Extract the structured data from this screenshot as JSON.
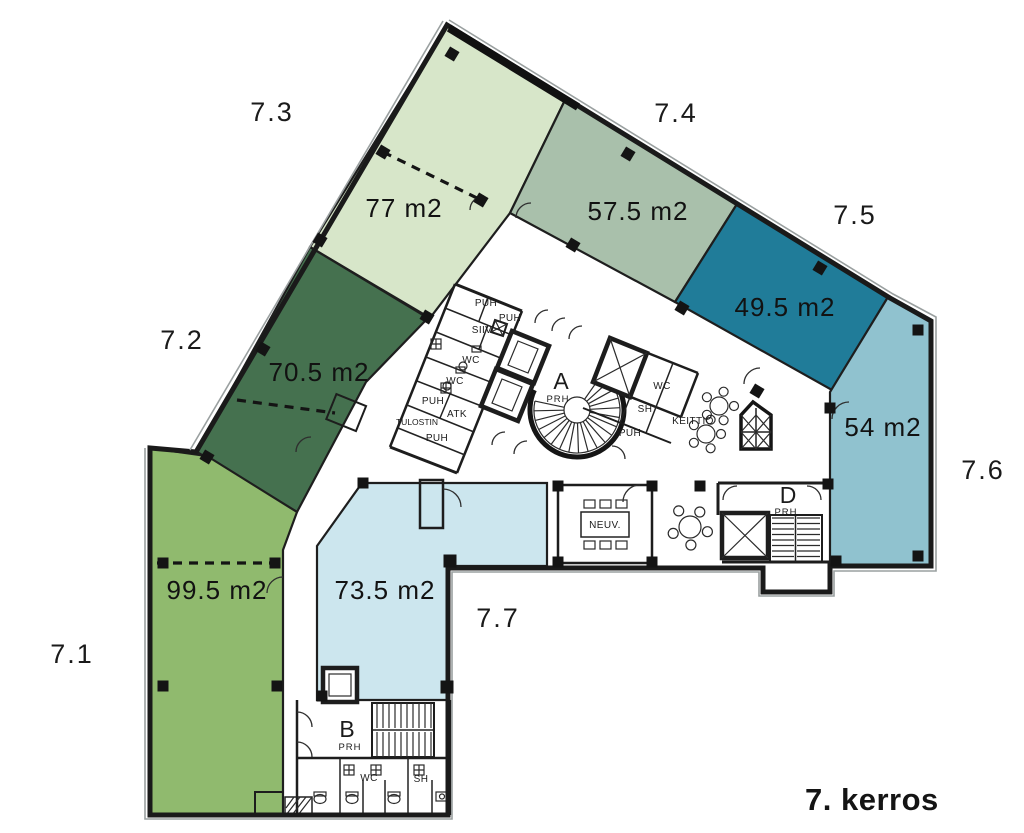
{
  "title": "7. kerros",
  "zones": {
    "z71": {
      "id": "7.1",
      "area": "99.5 m2",
      "color": "#90ba6e"
    },
    "z72": {
      "id": "7.2",
      "area": "70.5 m2",
      "color": "#45714f"
    },
    "z73": {
      "id": "7.3",
      "area": "77 m2",
      "color": "#d7e6c9"
    },
    "z74": {
      "id": "7.4",
      "area": "57.5 m2",
      "color": "#a9c0ab"
    },
    "z75": {
      "id": "7.5",
      "area": "49.5 m2",
      "color": "#207c99"
    },
    "z76": {
      "id": "7.6",
      "area": "54 m2",
      "color": "#90c2cf",
      "label_color": "#1c5066"
    },
    "z77": {
      "id": "7.7",
      "area": "73.5 m2",
      "color": "#cce6ee"
    }
  },
  "core_rooms": {
    "puh": "PUH",
    "siiv": "SIIV",
    "wc": "WC",
    "atk": "ATK",
    "tulostin": "TULOSTIN",
    "keittio": "KEITTIÖ",
    "sh": "SH",
    "neuv": "NEUV.",
    "prh": "PRH",
    "stair_a": "A",
    "stair_b": "B",
    "stair_d": "D"
  },
  "colors": {
    "wall": "#1d1d1d",
    "facade_line": "#9aa0a0"
  }
}
